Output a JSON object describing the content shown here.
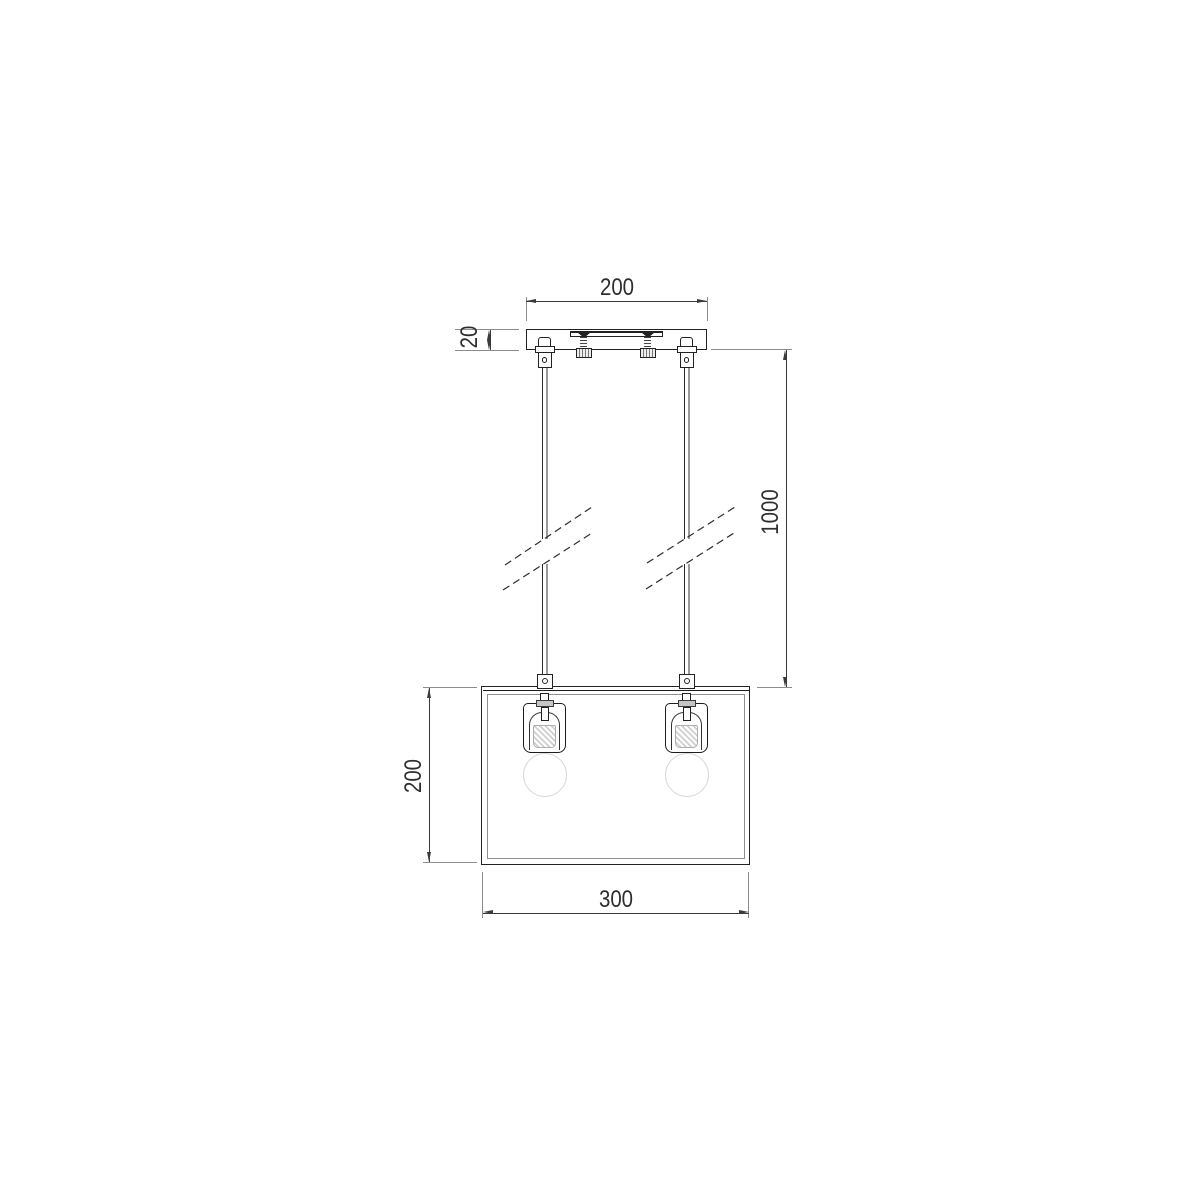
{
  "meta": {
    "description": "Technical dimension drawing (front elevation) of a two-light pendant ceiling lamp: ceiling canopy with mounting bracket, two suspension rods with break marks, rectangular open shade frame with two bulbs"
  },
  "dimensions": {
    "canopy_width": "200",
    "canopy_height": "20",
    "suspension_length": "1000",
    "shade_height": "200",
    "shade_width": "300"
  },
  "colors": {
    "background": "#ffffff",
    "outline": "#222222",
    "dimension_line": "#3a3a3a",
    "extension_line": "#8c8c8c",
    "rod_shadow": "#9a9a9a",
    "bulb_outline": "#d7d7d7",
    "frame_inner": "#8f8f8f"
  }
}
